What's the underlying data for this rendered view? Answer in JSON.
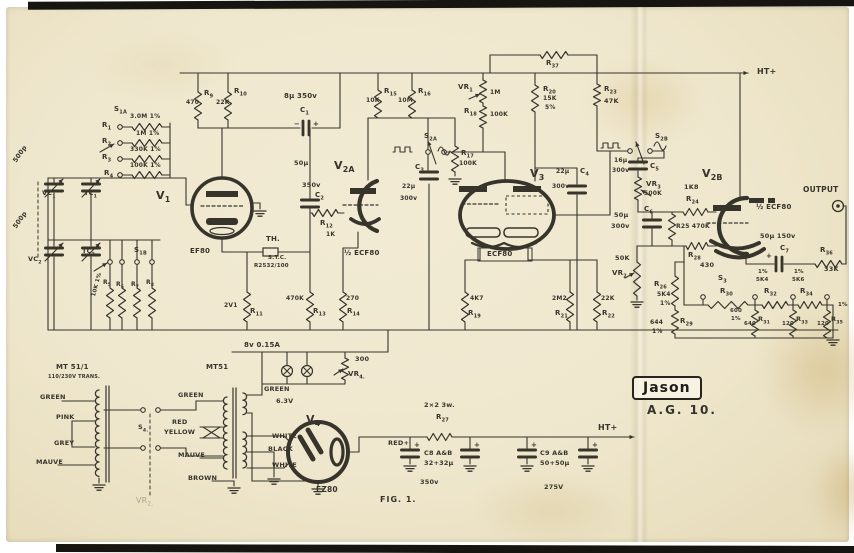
{
  "logo": {
    "brand": "Jason",
    "model": "A.G. 10."
  },
  "figure_label": "FIG. 1.",
  "colors": {
    "ink": "#37342c",
    "paper": "#f2ebd4",
    "edge": "#17150f"
  },
  "labels": [
    {
      "t": "S1A",
      "x": 114,
      "y": 106
    },
    {
      "t": "3.0M 1%",
      "x": 130,
      "y": 114,
      "s": 6
    },
    {
      "t": "R1",
      "x": 102,
      "y": 122
    },
    {
      "t": "1M 1%",
      "x": 136,
      "y": 131,
      "s": 6
    },
    {
      "t": "R2",
      "x": 102,
      "y": 138
    },
    {
      "t": "330K 1%",
      "x": 130,
      "y": 147,
      "s": 6
    },
    {
      "t": "R3",
      "x": 102,
      "y": 154
    },
    {
      "t": "100K 1%",
      "x": 130,
      "y": 163,
      "s": 6
    },
    {
      "t": "R4",
      "x": 104,
      "y": 170
    },
    {
      "t": "500p",
      "x": 12,
      "y": 160,
      "r": -55,
      "s": 6.5
    },
    {
      "t": "VC1",
      "x": 42,
      "y": 190,
      "s": 6.5
    },
    {
      "t": "TC1",
      "x": 84,
      "y": 190,
      "s": 6.5
    },
    {
      "t": "V1",
      "x": 156,
      "y": 190,
      "s": 11
    },
    {
      "t": "500p",
      "x": 12,
      "y": 226,
      "r": -55,
      "s": 6.5
    },
    {
      "t": "VC2",
      "x": 28,
      "y": 256,
      "s": 6.5
    },
    {
      "t": "TC2",
      "x": 82,
      "y": 248,
      "s": 6.5
    },
    {
      "t": "S1B",
      "x": 134,
      "y": 247
    },
    {
      "t": "R5",
      "x": 103,
      "y": 280,
      "s": 6
    },
    {
      "t": "R6",
      "x": 116,
      "y": 282,
      "s": 6
    },
    {
      "t": "R7",
      "x": 131,
      "y": 282,
      "s": 6
    },
    {
      "t": "R8",
      "x": 146,
      "y": 280,
      "s": 6
    },
    {
      "t": "10K 1%",
      "x": 92,
      "y": 296,
      "r": -75,
      "s": 5.5
    },
    {
      "t": "R9",
      "x": 204,
      "y": 90
    },
    {
      "t": "470",
      "x": 186,
      "y": 100,
      "s": 6
    },
    {
      "t": "R10",
      "x": 234,
      "y": 88
    },
    {
      "t": "22K",
      "x": 216,
      "y": 100,
      "s": 6
    },
    {
      "t": "EF80",
      "x": 190,
      "y": 248
    },
    {
      "t": "TH.",
      "x": 266,
      "y": 236
    },
    {
      "t": "S.T.C.",
      "x": 268,
      "y": 256,
      "s": 5.5
    },
    {
      "t": "R2532/100",
      "x": 254,
      "y": 264,
      "s": 5.5
    },
    {
      "t": "2V1",
      "x": 224,
      "y": 303,
      "s": 6
    },
    {
      "t": "R11",
      "x": 250,
      "y": 308
    },
    {
      "t": "470K",
      "x": 286,
      "y": 296,
      "s": 6
    },
    {
      "t": "R13",
      "x": 313,
      "y": 308
    },
    {
      "t": "270",
      "x": 346,
      "y": 296,
      "s": 6
    },
    {
      "t": "R14",
      "x": 347,
      "y": 308
    },
    {
      "t": "8µ 350v",
      "x": 284,
      "y": 93
    },
    {
      "t": "C1",
      "x": 300,
      "y": 107
    },
    {
      "t": "−",
      "x": 294,
      "y": 121,
      "s": 7
    },
    {
      "t": "+",
      "x": 313,
      "y": 121,
      "s": 7
    },
    {
      "t": "50µ",
      "x": 294,
      "y": 160,
      "s": 6.5
    },
    {
      "t": "350v",
      "x": 302,
      "y": 182,
      "s": 6.5
    },
    {
      "t": "C2",
      "x": 315,
      "y": 192
    },
    {
      "t": "R12",
      "x": 320,
      "y": 220
    },
    {
      "t": "1K",
      "x": 326,
      "y": 232,
      "s": 6
    },
    {
      "t": "V2A",
      "x": 334,
      "y": 160,
      "s": 11
    },
    {
      "t": "½ ECF80",
      "x": 344,
      "y": 250
    },
    {
      "t": "R15",
      "x": 384,
      "y": 88
    },
    {
      "t": "10K",
      "x": 366,
      "y": 98,
      "s": 6
    },
    {
      "t": "R16",
      "x": 418,
      "y": 88
    },
    {
      "t": "10M",
      "x": 398,
      "y": 98,
      "s": 6
    },
    {
      "t": "VR1",
      "x": 458,
      "y": 84
    },
    {
      "t": "1M",
      "x": 490,
      "y": 90,
      "s": 6
    },
    {
      "t": "R18",
      "x": 464,
      "y": 108
    },
    {
      "t": "100K",
      "x": 490,
      "y": 112,
      "s": 6
    },
    {
      "t": "S2A",
      "x": 424,
      "y": 133
    },
    {
      "t": "C3",
      "x": 415,
      "y": 164
    },
    {
      "t": "22µ",
      "x": 402,
      "y": 184,
      "s": 6
    },
    {
      "t": "300v",
      "x": 400,
      "y": 196,
      "s": 6
    },
    {
      "t": "R17",
      "x": 461,
      "y": 150
    },
    {
      "t": "100K",
      "x": 459,
      "y": 161,
      "s": 6
    },
    {
      "t": "R20",
      "x": 543,
      "y": 86
    },
    {
      "t": "15K",
      "x": 543,
      "y": 96,
      "s": 6
    },
    {
      "t": "5%",
      "x": 545,
      "y": 105,
      "s": 6
    },
    {
      "t": "R37",
      "x": 546,
      "y": 60
    },
    {
      "t": "R23",
      "x": 604,
      "y": 86
    },
    {
      "t": "47K",
      "x": 604,
      "y": 98,
      "s": 6.5
    },
    {
      "t": "V3",
      "x": 530,
      "y": 168,
      "s": 11
    },
    {
      "t": "22µ",
      "x": 556,
      "y": 169,
      "s": 6
    },
    {
      "t": "C4",
      "x": 580,
      "y": 168
    },
    {
      "t": "300v",
      "x": 552,
      "y": 184,
      "s": 6
    },
    {
      "t": "ECF80",
      "x": 487,
      "y": 251
    },
    {
      "t": "S2B",
      "x": 655,
      "y": 133
    },
    {
      "t": "16µ",
      "x": 614,
      "y": 158,
      "s": 6
    },
    {
      "t": "300v",
      "x": 612,
      "y": 168,
      "s": 6
    },
    {
      "t": "C5",
      "x": 650,
      "y": 163
    },
    {
      "t": "VR3",
      "x": 646,
      "y": 181
    },
    {
      "t": "500K",
      "x": 644,
      "y": 191,
      "s": 6
    },
    {
      "t": "4K7",
      "x": 470,
      "y": 296,
      "s": 6
    },
    {
      "t": "R19",
      "x": 468,
      "y": 310
    },
    {
      "t": "2M2",
      "x": 552,
      "y": 296,
      "s": 6
    },
    {
      "t": "R21",
      "x": 555,
      "y": 310
    },
    {
      "t": "22K",
      "x": 601,
      "y": 296,
      "s": 6
    },
    {
      "t": "R22",
      "x": 602,
      "y": 310
    },
    {
      "t": "50µ",
      "x": 614,
      "y": 212,
      "s": 6.5
    },
    {
      "t": "300v",
      "x": 611,
      "y": 223,
      "s": 6.5
    },
    {
      "t": "C6",
      "x": 644,
      "y": 206
    },
    {
      "t": "50K",
      "x": 615,
      "y": 255,
      "s": 6.5
    },
    {
      "t": "VR2",
      "x": 612,
      "y": 270
    },
    {
      "t": "V2B",
      "x": 702,
      "y": 168,
      "s": 11
    },
    {
      "t": "1K8",
      "x": 684,
      "y": 184,
      "s": 6.5
    },
    {
      "t": "R24",
      "x": 686,
      "y": 196
    },
    {
      "t": "R25 470K",
      "x": 676,
      "y": 224,
      "s": 6
    },
    {
      "t": "½ ECF80",
      "x": 756,
      "y": 204
    },
    {
      "t": "R28",
      "x": 688,
      "y": 252
    },
    {
      "t": "430",
      "x": 700,
      "y": 262,
      "s": 6.5
    },
    {
      "t": "R26",
      "x": 654,
      "y": 281
    },
    {
      "t": "5K4",
      "x": 657,
      "y": 292,
      "s": 6
    },
    {
      "t": "1%",
      "x": 660,
      "y": 301,
      "s": 6
    },
    {
      "t": "644",
      "x": 650,
      "y": 320,
      "s": 6
    },
    {
      "t": "1%",
      "x": 652,
      "y": 329,
      "s": 6
    },
    {
      "t": "R29",
      "x": 680,
      "y": 318
    },
    {
      "t": "50µ 150v",
      "x": 760,
      "y": 233,
      "s": 6.5
    },
    {
      "t": "C7",
      "x": 780,
      "y": 245
    },
    {
      "t": "+",
      "x": 766,
      "y": 253,
      "s": 7
    },
    {
      "t": "R36",
      "x": 820,
      "y": 247
    },
    {
      "t": "33K",
      "x": 824,
      "y": 266,
      "s": 6.5
    },
    {
      "t": "OUTPUT",
      "x": 803,
      "y": 186,
      "s": 7.5,
      "b": 1
    },
    {
      "t": "S3",
      "x": 718,
      "y": 275
    },
    {
      "t": "R30",
      "x": 720,
      "y": 288
    },
    {
      "t": "600",
      "x": 730,
      "y": 309,
      "s": 5.5
    },
    {
      "t": "1%",
      "x": 731,
      "y": 317,
      "s": 5.5
    },
    {
      "t": "1%",
      "x": 758,
      "y": 270,
      "s": 5.5
    },
    {
      "t": "5K4",
      "x": 756,
      "y": 278,
      "s": 5.5
    },
    {
      "t": "R32",
      "x": 764,
      "y": 288
    },
    {
      "t": "1%",
      "x": 794,
      "y": 270,
      "s": 5.5
    },
    {
      "t": "5K6",
      "x": 792,
      "y": 278,
      "s": 5.5
    },
    {
      "t": "R34",
      "x": 800,
      "y": 288
    },
    {
      "t": "R31",
      "x": 758,
      "y": 316,
      "s": 6.5
    },
    {
      "t": "640",
      "x": 744,
      "y": 322,
      "s": 5.5
    },
    {
      "t": "R33",
      "x": 796,
      "y": 316,
      "s": 6.5
    },
    {
      "t": "120",
      "x": 782,
      "y": 322,
      "s": 5.5
    },
    {
      "t": "R35",
      "x": 831,
      "y": 316,
      "s": 6.5
    },
    {
      "t": "120",
      "x": 817,
      "y": 322,
      "s": 5.5
    },
    {
      "t": "1%",
      "x": 838,
      "y": 303,
      "s": 5.5
    },
    {
      "t": "HT+",
      "x": 757,
      "y": 68,
      "s": 8,
      "b": 1
    },
    {
      "t": "8v 0.15A",
      "x": 244,
      "y": 342
    },
    {
      "t": "300",
      "x": 355,
      "y": 356,
      "s": 6.5
    },
    {
      "t": "VR4.",
      "x": 348,
      "y": 371
    },
    {
      "t": "GREEN",
      "x": 264,
      "y": 386,
      "s": 6.5
    },
    {
      "t": "6.3V",
      "x": 276,
      "y": 398,
      "s": 6.5
    },
    {
      "t": "V4",
      "x": 306,
      "y": 414,
      "s": 11
    },
    {
      "t": "WHITE",
      "x": 272,
      "y": 433,
      "s": 6.5
    },
    {
      "t": "BLACK",
      "x": 268,
      "y": 446,
      "s": 6.5
    },
    {
      "t": "WHITE",
      "x": 272,
      "y": 462,
      "s": 6.5
    },
    {
      "t": "EZ80",
      "x": 316,
      "y": 486,
      "s": 7.5
    },
    {
      "t": "2×2 3w.",
      "x": 424,
      "y": 402,
      "s": 6.5
    },
    {
      "t": "R27",
      "x": 436,
      "y": 414
    },
    {
      "t": "RED+",
      "x": 388,
      "y": 440,
      "s": 6.5
    },
    {
      "t": "C8 A&B",
      "x": 424,
      "y": 450,
      "s": 6.5
    },
    {
      "t": "32+32µ",
      "x": 424,
      "y": 460,
      "s": 6.5
    },
    {
      "t": "350v",
      "x": 420,
      "y": 479,
      "s": 6.5
    },
    {
      "t": "C9 A&B",
      "x": 540,
      "y": 450,
      "s": 6.5
    },
    {
      "t": "50+50µ",
      "x": 540,
      "y": 460,
      "s": 6.5
    },
    {
      "t": "275V",
      "x": 544,
      "y": 484,
      "s": 6.5
    },
    {
      "t": "HT+",
      "x": 598,
      "y": 424,
      "s": 8,
      "b": 1
    },
    {
      "t": "+",
      "x": 414,
      "y": 442,
      "s": 7
    },
    {
      "t": "+",
      "x": 474,
      "y": 442,
      "s": 7
    },
    {
      "t": "+",
      "x": 531,
      "y": 442,
      "s": 7
    },
    {
      "t": "+",
      "x": 592,
      "y": 442,
      "s": 7
    },
    {
      "t": "MT 51/1",
      "x": 56,
      "y": 364,
      "b": 1
    },
    {
      "t": "110/230V TRANS.",
      "x": 48,
      "y": 375,
      "s": 5
    },
    {
      "t": "GREEN",
      "x": 40,
      "y": 394,
      "s": 6.5
    },
    {
      "t": "PINK",
      "x": 56,
      "y": 414,
      "s": 6.5
    },
    {
      "t": "GREY",
      "x": 54,
      "y": 440,
      "s": 6.5
    },
    {
      "t": "MAUVE",
      "x": 36,
      "y": 459,
      "s": 6.5
    },
    {
      "t": "S4.",
      "x": 138,
      "y": 424,
      "s": 6.5
    },
    {
      "t": "MT51",
      "x": 206,
      "y": 364,
      "b": 1
    },
    {
      "t": "GREEN",
      "x": 178,
      "y": 392,
      "s": 6.5
    },
    {
      "t": "RED",
      "x": 172,
      "y": 419,
      "s": 6.5
    },
    {
      "t": "YELLOW",
      "x": 164,
      "y": 429,
      "s": 6.5
    },
    {
      "t": "MAUVE",
      "x": 178,
      "y": 452,
      "s": 6.5
    },
    {
      "t": "BROWN",
      "x": 188,
      "y": 475,
      "s": 6.5
    },
    {
      "t": "VR2.",
      "x": 136,
      "y": 497,
      "f": 1,
      "s": 8
    }
  ]
}
